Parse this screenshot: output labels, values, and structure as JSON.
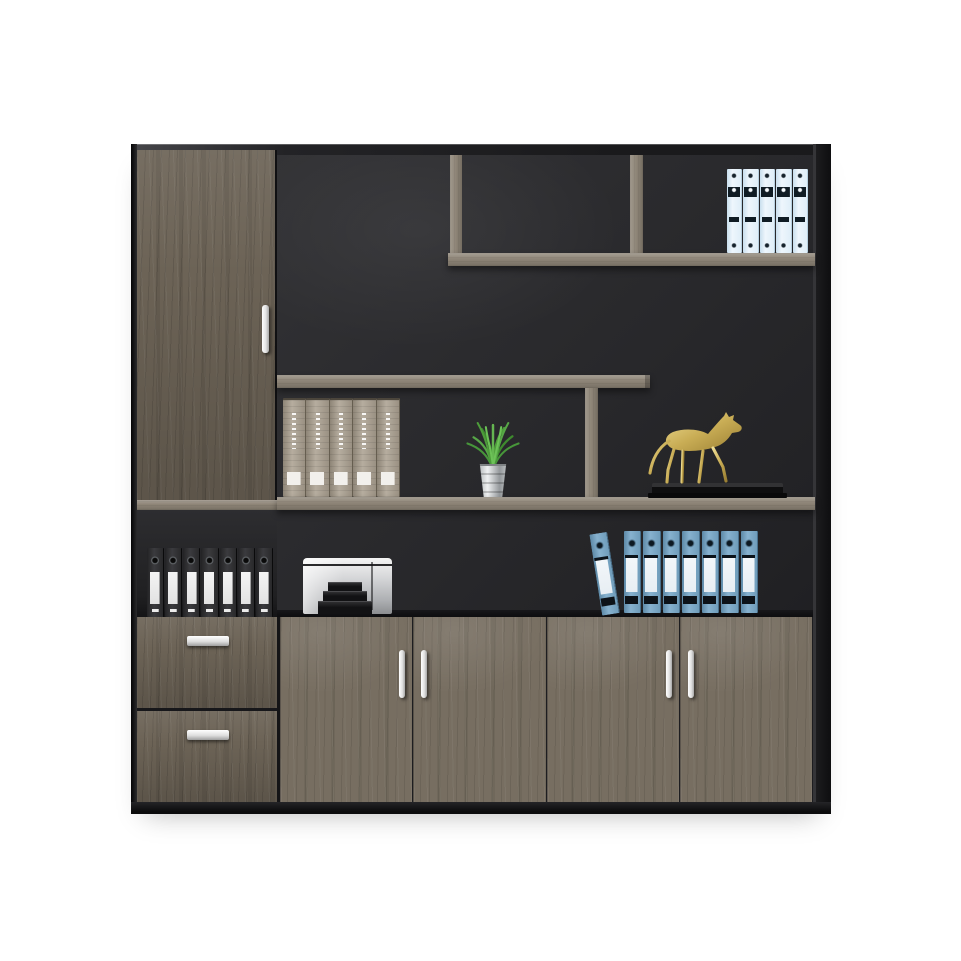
{
  "scene": {
    "type": "product-photo",
    "subject": "wood office filing cabinet bookcase with open display shelving",
    "background": "plain white"
  },
  "colors": {
    "bg": "#ffffff",
    "frame": "#19191b",
    "wood": "#776e61",
    "wood-dark": "#6c6356",
    "shelf": "#8e8577",
    "interior": "#28282b",
    "handle": "#f4f4f2",
    "binder-light-blue": "#dfeef8",
    "binder-blue": "#79a4c2",
    "binder-black": "#2e2e30",
    "book-gray": "#a89e90",
    "horse-gold": "#c9ad55",
    "horse-base": "#0e0e0f",
    "printer-silver": "#d6d7d9",
    "plant-green": "#4d9c3a",
    "pot-silver": "#c3c6c8"
  },
  "objects": {
    "tall_door": {
      "count": 1,
      "handle": "vertical bar"
    },
    "top_shelf_binders": {
      "count": 5,
      "color_key": "binder-light-blue"
    },
    "shelf_books": {
      "count": 5,
      "color_key": "book-gray"
    },
    "plant": {
      "count": 1,
      "kind": "grass in metal pot"
    },
    "horse_statue": {
      "count": 1,
      "kind": "gold horse on black plinth"
    },
    "black_binders": {
      "count": 7,
      "color_key": "binder-black"
    },
    "printer": {
      "count": 1
    },
    "blue_binders": {
      "count": 8,
      "color_key": "binder-blue",
      "first_tilted": true
    },
    "bottom_doors": {
      "count": 4,
      "handle": "vertical bar pairs"
    },
    "drawers": {
      "count": 2,
      "handle": "horizontal bar"
    }
  }
}
